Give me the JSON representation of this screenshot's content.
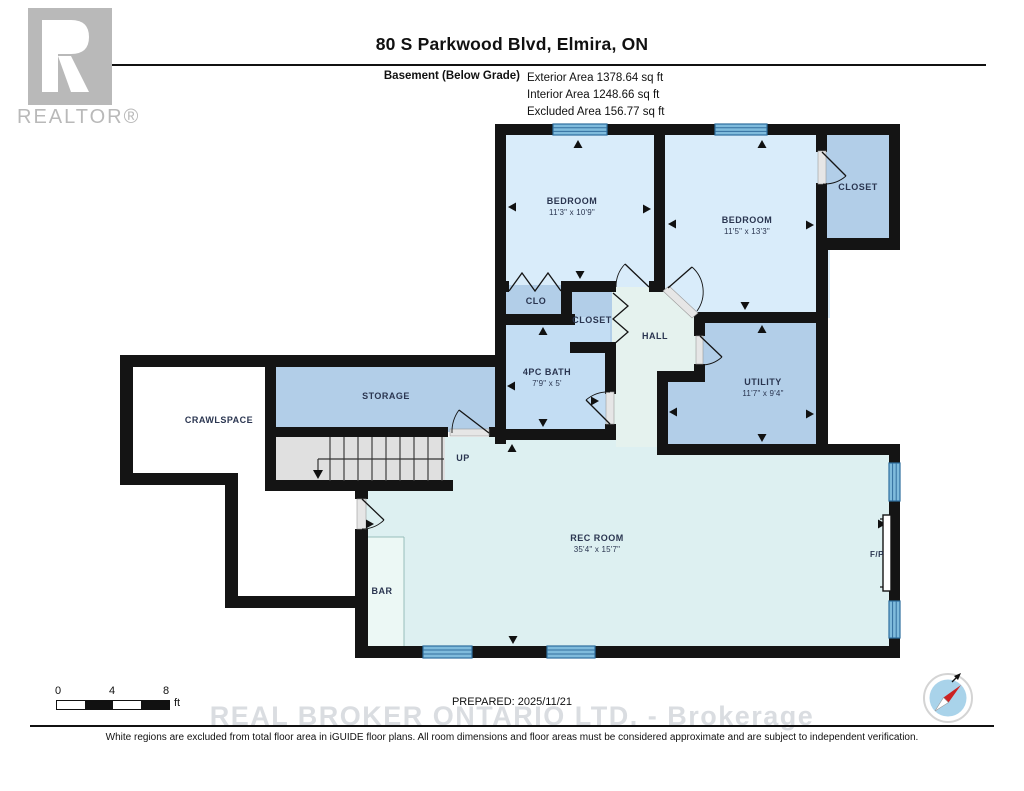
{
  "header": {
    "title": "80 S Parkwood Blvd, Elmira, ON",
    "floor_label": "Basement (Below Grade)",
    "stats": [
      "Exterior Area 1378.64 sq ft",
      "Interior Area 1248.66 sq ft",
      "Excluded Area 156.77 sq ft"
    ]
  },
  "logo": {
    "brand": "REALTOR®"
  },
  "rooms": {
    "bedroom1": {
      "name": "BEDROOM",
      "dims": "11'3\" x 10'9\""
    },
    "bedroom2": {
      "name": "BEDROOM",
      "dims": "11'5\" x 13'3\""
    },
    "closet_tr": {
      "name": "CLOSET"
    },
    "clo": {
      "name": "CLO"
    },
    "closet_mid": {
      "name": "CLOSET"
    },
    "hall": {
      "name": "HALL"
    },
    "bath": {
      "name": "4PC BATH",
      "dims": "7'9\" x 5'"
    },
    "utility": {
      "name": "UTILITY",
      "dims": "11'7\" x 9'4\""
    },
    "storage": {
      "name": "STORAGE"
    },
    "crawlspace": {
      "name": "CRAWLSPACE"
    },
    "stairs": {
      "name": "UP"
    },
    "rec": {
      "name": "REC ROOM",
      "dims": "35'4\" x 15'7\""
    },
    "bar": {
      "name": "BAR"
    },
    "fireplace": {
      "name": "F/P"
    }
  },
  "footer": {
    "scale": {
      "t0": "0",
      "t4": "4",
      "t8": "8",
      "unit": "ft"
    },
    "prepared": "PREPARED: 2025/11/21",
    "watermark": "REAL BROKER ONTARIO LTD. - Brokerage",
    "disclaimer": "White regions are excluded from total floor area in iGUIDE floor plans. All room dimensions and floor areas must be considered approximate and are subject to independent verification.",
    "compass_north": "N"
  },
  "colors": {
    "wall": "#141414",
    "bedroom": "#d9ecfa",
    "closet": "#b2cee8",
    "bath": "#c3ddf3",
    "hall": "#e5f2ee",
    "utility": "#b2cee8",
    "storage": "#b2cee8",
    "rec": "#ddf0f1",
    "bar": "#ecf8f5",
    "stairs": "#e0e0e0",
    "window": "#7fbbdc",
    "compass_face": "#a9d3ea",
    "compass_needle": "#cc2222",
    "logo_grey": "#b9b9b9"
  }
}
